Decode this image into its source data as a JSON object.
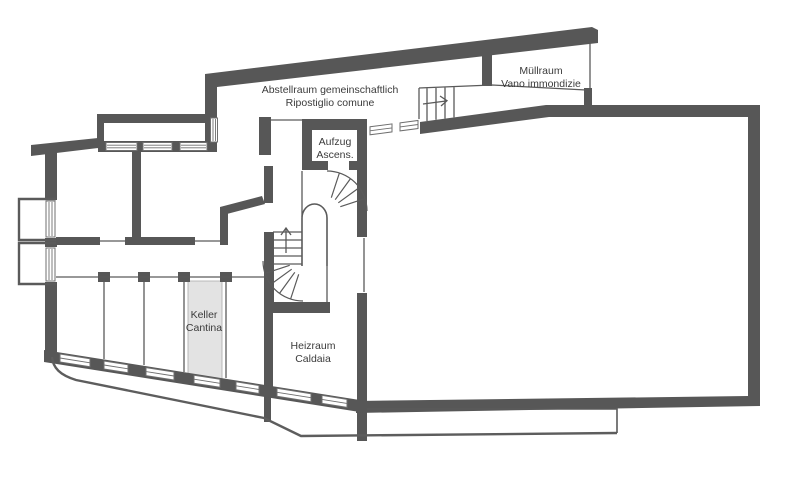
{
  "plan": {
    "rooms": {
      "abstellraum": {
        "name_de": "Abstellraum gemeinschaftlich",
        "name_it": "Ripostiglio comune"
      },
      "muellraum": {
        "name_de": "Müllraum",
        "name_it": "Vano immondizie"
      },
      "aufzug": {
        "name_de": "Aufzug",
        "name_it": "Ascens."
      },
      "keller": {
        "name_de": "Keller",
        "name_it": "Cantina"
      },
      "heizraum": {
        "name_de": "Heizraum",
        "name_it": "Caldaia"
      }
    },
    "colors": {
      "wall": "#575757",
      "thin_line": "#5a5a5a",
      "highlight_fill": "#e3e3e3",
      "label_text": "#3b3b3b",
      "background": "#ffffff"
    }
  }
}
